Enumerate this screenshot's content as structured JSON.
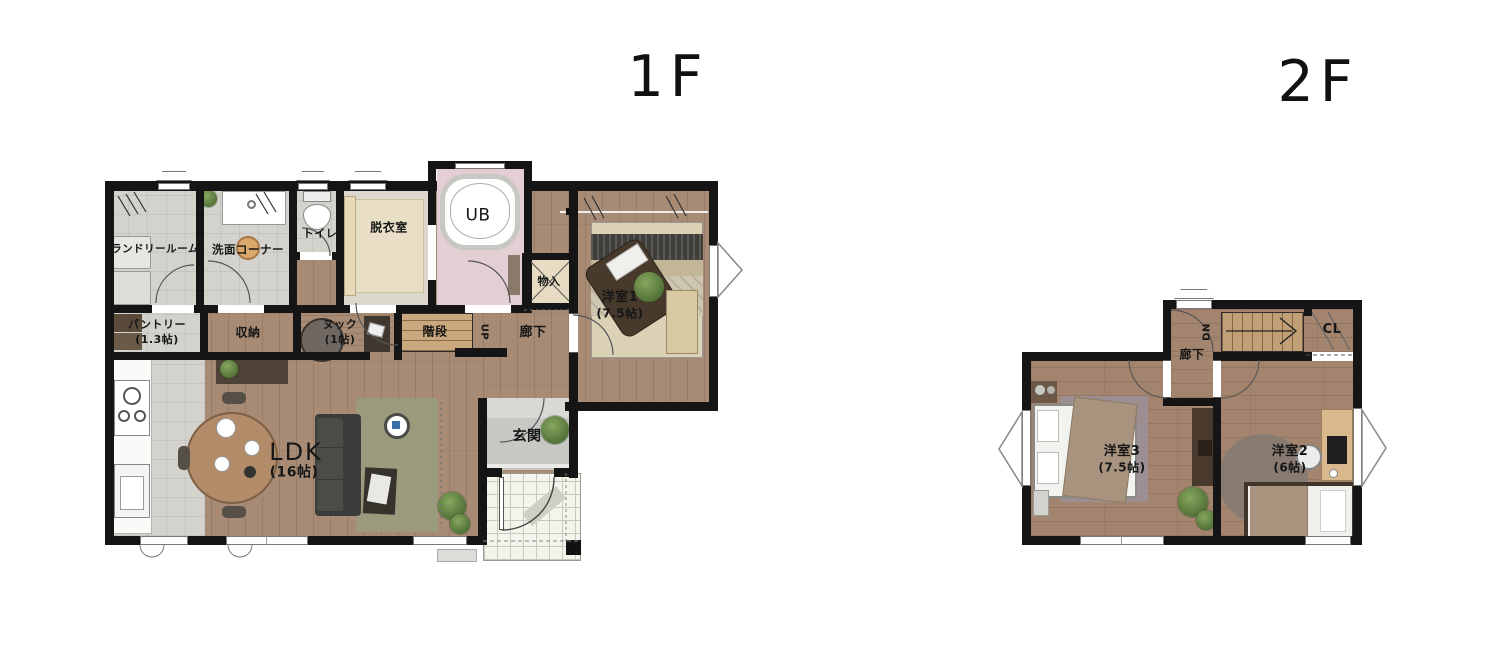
{
  "colors": {
    "wall": "#151515",
    "wood_floor_1f": "#a78b75",
    "wood_floor_2f": "#a3846e",
    "tile_grey": "#d3d2cd",
    "tile_beige": "#e9dfc6",
    "bath_pink": "#e3ced3",
    "stair_wood": "#c9a87e",
    "rug_green": "#9a9a7c",
    "rug_mauve": "#9c8e91",
    "rug_grey": "#857b72",
    "porch_tile": "#f4f3ec"
  },
  "floor1": {
    "title": "1F",
    "rooms": {
      "laundry": {
        "label": "ランドリールーム"
      },
      "washroom": {
        "label": "洗面コーナー"
      },
      "toilet": {
        "label": "トイレ"
      },
      "dressing": {
        "label": "脱衣室"
      },
      "bath": {
        "label": "UB"
      },
      "closet_hall": {
        "label": "物入"
      },
      "bedroom1": {
        "label": "洋室1",
        "size": "(7.5帖)"
      },
      "pantry": {
        "label": "パントリー",
        "size": "(1.3帖)"
      },
      "storage": {
        "label": "収納"
      },
      "nook": {
        "label": "ヌック",
        "size": "(1帖)"
      },
      "stairs": {
        "label": "階段",
        "direction": "UP"
      },
      "hallway": {
        "label": "廊下"
      },
      "ldk": {
        "label": "LDK",
        "size": "(16帖)"
      },
      "entrance": {
        "label": "玄関"
      }
    }
  },
  "floor2": {
    "title": "2F",
    "rooms": {
      "hallway": {
        "label": "廊下"
      },
      "stairs": {
        "direction": "DN"
      },
      "closet": {
        "label": "CL"
      },
      "bedroom3": {
        "label": "洋室3",
        "size": "(7.5帖)"
      },
      "bedroom2": {
        "label": "洋室2",
        "size": "(6帖)"
      }
    }
  }
}
